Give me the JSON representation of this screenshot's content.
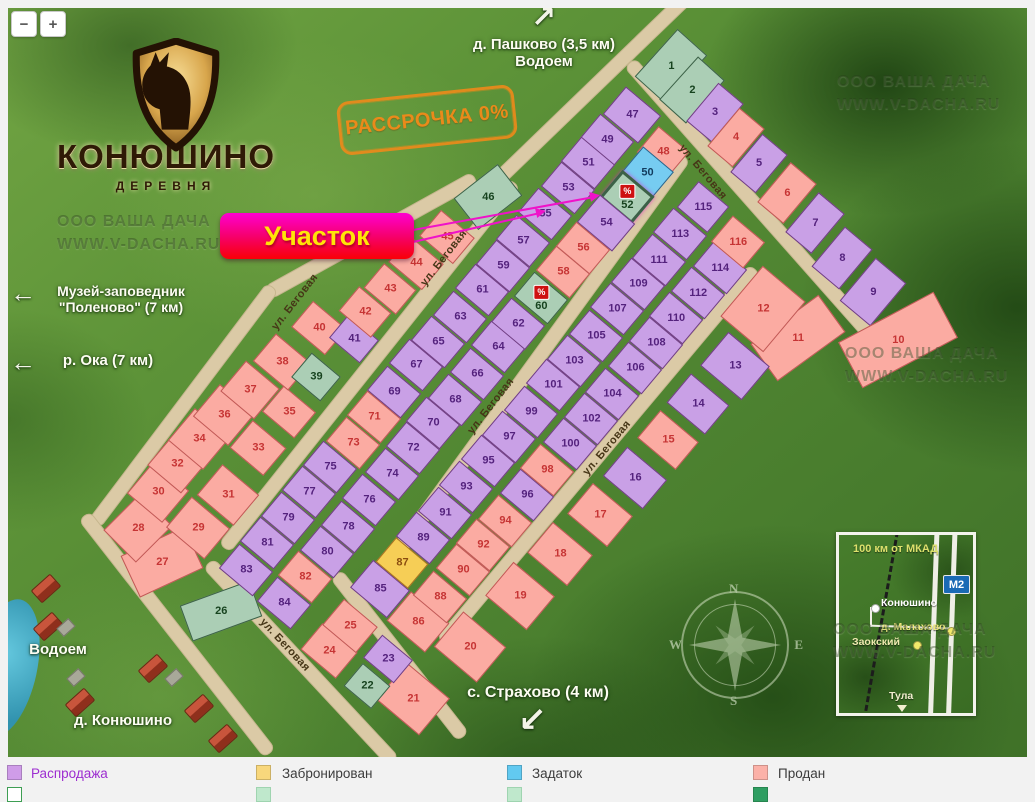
{
  "controls": {
    "zoom_out": "−",
    "zoom_in": "+"
  },
  "logo": {
    "title": "КОНЮШИНО",
    "subtitle": "ДЕРЕВНЯ"
  },
  "promo": {
    "text": "РАССРОЧКА 0%"
  },
  "uchastok": {
    "label": "Участок",
    "pointer_lines": [
      {
        "x1": 413,
        "y1": 241,
        "x2": 540,
        "y2": 212
      },
      {
        "x1": 413,
        "y1": 229,
        "x2": 594,
        "y2": 196
      }
    ]
  },
  "landmarks": [
    {
      "lines": [
        "д. Пашково (3,5 км)",
        "Водоем"
      ],
      "x": 544,
      "y": 36,
      "size": 15,
      "arrow": "↗",
      "ax": 531,
      "ay": 0,
      "asize": 30
    },
    {
      "lines": [
        "Музей-заповедник",
        "\"Поленово\" (7 км)"
      ],
      "x": 121,
      "y": 283,
      "size": 14,
      "arrow": "←",
      "ax": 10,
      "ay": 278,
      "asize": 26
    },
    {
      "lines": [
        "р. Ока (7 км)"
      ],
      "x": 108,
      "y": 352,
      "size": 15,
      "arrow": "←",
      "ax": 10,
      "ay": 347,
      "asize": 26
    },
    {
      "lines": [
        "Водоем"
      ],
      "x": 58,
      "y": 641,
      "size": 15
    },
    {
      "lines": [
        "д. Конюшино"
      ],
      "x": 123,
      "y": 712,
      "size": 15
    },
    {
      "lines": [
        "с. Страхово (4 км)"
      ],
      "x": 538,
      "y": 684,
      "size": 16,
      "arrow": "↙",
      "ax": 518,
      "ay": 700,
      "asize": 34
    }
  ],
  "streets": {
    "label": "ул. Беговая",
    "labels": [
      {
        "x": 296,
        "y": 302,
        "rot": -52
      },
      {
        "x": 445,
        "y": 258,
        "rot": -52
      },
      {
        "x": 492,
        "y": 406,
        "rot": -52
      },
      {
        "x": 608,
        "y": 448,
        "rot": -50
      },
      {
        "x": 704,
        "y": 172,
        "rot": 50
      },
      {
        "x": 286,
        "y": 645,
        "rot": 47
      }
    ]
  },
  "roads": [
    [
      594,
      85,
      265,
      -44
    ],
    [
      370,
      235,
      235,
      -29
    ],
    [
      182,
      405,
      295,
      -53
    ],
    [
      176,
      634,
      300,
      52
    ],
    [
      368,
      365,
      465,
      -51.5
    ],
    [
      536,
      359,
      500,
      -54
    ],
    [
      597,
      455,
      485,
      -50
    ],
    [
      755,
      205,
      380,
      48.5
    ],
    [
      300,
      662,
      270,
      47
    ],
    [
      398,
      655,
      205,
      52
    ]
  ],
  "statuses": {
    "p": {
      "name": "Распродажа",
      "fill": "#c9a0e6",
      "num": "#54227d",
      "border": "rgba(82,28,96,0.75)"
    },
    "r": {
      "name": "Продан",
      "fill": "#fbaba2",
      "num": "#c63434",
      "border": "rgba(168,52,52,0.7)"
    },
    "g": {
      "name": "Свободен",
      "fill": "#abceb5",
      "num": "#17431f",
      "border": "rgba(32,70,44,0.8)"
    },
    "b": {
      "name": "Задаток",
      "fill": "#76ccf1",
      "num": "#123c5e",
      "border": "rgba(26,72,110,0.8)"
    },
    "y": {
      "name": "Забронирован",
      "fill": "#f6ce56",
      "num": "#8a4d10",
      "border": "rgba(150,90,20,0.8)"
    }
  },
  "plots": [
    [
      1,
      671,
      66,
      "g",
      64,
      40,
      -48
    ],
    [
      2,
      692,
      90,
      "g",
      58,
      36,
      -48
    ],
    [
      3,
      715,
      112,
      "p",
      50,
      33
    ],
    [
      4,
      736,
      137,
      "r",
      50,
      33
    ],
    [
      5,
      759,
      163,
      "p",
      50,
      33
    ],
    [
      6,
      787,
      193,
      "r",
      52,
      34
    ],
    [
      7,
      815,
      223,
      "p",
      52,
      34
    ],
    [
      8,
      842,
      258,
      "p",
      52,
      36
    ],
    [
      9,
      873,
      292,
      "p",
      56,
      40
    ],
    [
      10,
      898,
      340,
      "r",
      108,
      52,
      -28
    ],
    [
      11,
      798,
      338,
      "r",
      84,
      46,
      -36
    ],
    [
      12,
      763,
      309,
      "r",
      66,
      56
    ],
    [
      13,
      735,
      366,
      "p",
      44,
      54
    ],
    [
      14,
      698,
      404,
      "p",
      38,
      50
    ],
    [
      15,
      668,
      440,
      "r",
      36,
      50
    ],
    [
      16,
      635,
      478,
      "p",
      38,
      52
    ],
    [
      17,
      600,
      515,
      "r",
      40,
      52
    ],
    [
      18,
      560,
      554,
      "r",
      40,
      52
    ],
    [
      19,
      520,
      596,
      "r",
      44,
      54
    ],
    [
      20,
      470,
      647,
      "r",
      46,
      56
    ],
    [
      21,
      413,
      699,
      "r",
      48,
      56
    ],
    [
      22,
      367,
      686,
      "g",
      30,
      36
    ],
    [
      23,
      388,
      659,
      "p",
      30,
      40
    ],
    [
      24,
      329,
      651,
      "r",
      34,
      46
    ],
    [
      25,
      350,
      626,
      "r",
      34,
      44
    ],
    [
      26,
      221,
      611,
      "g",
      74,
      38,
      -20
    ],
    [
      27,
      162,
      562,
      "r",
      70,
      46,
      -25
    ],
    [
      28,
      138,
      528,
      "r",
      52,
      46,
      -45
    ],
    [
      29,
      198,
      528,
      "r",
      40,
      50
    ],
    [
      30,
      158,
      492,
      "r",
      42,
      46
    ],
    [
      31,
      228,
      495,
      "r",
      40,
      48
    ],
    [
      32,
      177,
      464,
      "r",
      40,
      44
    ],
    [
      33,
      258,
      448,
      "r",
      36,
      44
    ],
    [
      34,
      199,
      439,
      "r",
      42,
      46
    ],
    [
      35,
      289,
      412,
      "r",
      34,
      42
    ],
    [
      36,
      224,
      415,
      "r",
      42,
      46
    ],
    [
      37,
      250,
      390,
      "r",
      40,
      44
    ],
    [
      38,
      282,
      362,
      "r",
      36,
      46
    ],
    [
      39,
      316,
      377,
      "g",
      32,
      38
    ],
    [
      40,
      319,
      328,
      "r",
      34,
      44
    ],
    [
      41,
      354,
      339,
      "p",
      30,
      40
    ],
    [
      42,
      365,
      312,
      "r",
      32,
      42
    ],
    [
      43,
      390,
      289,
      "r",
      32,
      42
    ],
    [
      44,
      416,
      263,
      "r",
      34,
      44
    ],
    [
      45,
      447,
      237,
      "r",
      34,
      44
    ],
    [
      46,
      488,
      197,
      "g",
      56,
      40,
      -38
    ],
    [
      47,
      632,
      115,
      "p",
      36,
      46
    ],
    [
      48,
      663,
      152,
      "r",
      34,
      40
    ],
    [
      49,
      607,
      140,
      "p"
    ],
    [
      50,
      647,
      173,
      "b",
      36,
      40
    ],
    [
      51,
      588,
      163,
      "p"
    ],
    [
      52,
      627,
      197,
      "g",
      36,
      42
    ],
    [
      53,
      568,
      188,
      "p"
    ],
    [
      54,
      606,
      223,
      "p",
      36,
      46
    ],
    [
      55,
      545,
      214,
      "p"
    ],
    [
      56,
      583,
      248,
      "r"
    ],
    [
      57,
      523,
      241,
      "p"
    ],
    [
      58,
      563,
      272,
      "r"
    ],
    [
      59,
      503,
      266,
      "p"
    ],
    [
      60,
      541,
      298,
      "g"
    ],
    [
      61,
      482,
      290,
      "p"
    ],
    [
      62,
      518,
      324,
      "p"
    ],
    [
      63,
      460,
      317,
      "p"
    ],
    [
      64,
      498,
      347,
      "p"
    ],
    [
      65,
      438,
      342,
      "p"
    ],
    [
      66,
      477,
      374,
      "p"
    ],
    [
      67,
      416,
      365,
      "p"
    ],
    [
      68,
      455,
      400,
      "p"
    ],
    [
      69,
      394,
      392,
      "p"
    ],
    [
      70,
      433,
      423,
      "p"
    ],
    [
      71,
      374,
      417,
      "r"
    ],
    [
      72,
      413,
      448,
      "p"
    ],
    [
      73,
      353,
      443,
      "r"
    ],
    [
      74,
      392,
      474,
      "p"
    ],
    [
      75,
      330,
      467,
      "p"
    ],
    [
      76,
      369,
      500,
      "p"
    ],
    [
      77,
      309,
      492,
      "p"
    ],
    [
      78,
      348,
      527,
      "p"
    ],
    [
      79,
      288,
      518,
      "p"
    ],
    [
      80,
      327,
      552,
      "p"
    ],
    [
      81,
      267,
      543,
      "p"
    ],
    [
      82,
      305,
      577,
      "r"
    ],
    [
      83,
      246,
      570,
      "p"
    ],
    [
      84,
      284,
      603,
      "p"
    ],
    [
      85,
      380,
      589,
      "p",
      36,
      48
    ],
    [
      86,
      418,
      622,
      "r",
      38,
      50
    ],
    [
      87,
      402,
      563,
      "y",
      32,
      42
    ],
    [
      88,
      440,
      597,
      "r"
    ],
    [
      89,
      423,
      538,
      "p"
    ],
    [
      90,
      463,
      570,
      "r"
    ],
    [
      91,
      445,
      513,
      "p"
    ],
    [
      92,
      483,
      545,
      "r"
    ],
    [
      93,
      466,
      487,
      "p"
    ],
    [
      94,
      505,
      521,
      "r"
    ],
    [
      95,
      488,
      461,
      "p"
    ],
    [
      96,
      527,
      495,
      "p"
    ],
    [
      97,
      509,
      437,
      "p"
    ],
    [
      98,
      547,
      470,
      "r"
    ],
    [
      99,
      531,
      412,
      "p"
    ],
    [
      100,
      570,
      444,
      "p"
    ],
    [
      101,
      553,
      385,
      "p"
    ],
    [
      102,
      591,
      419,
      "p"
    ],
    [
      103,
      574,
      361,
      "p"
    ],
    [
      104,
      612,
      394,
      "p"
    ],
    [
      105,
      596,
      336,
      "p"
    ],
    [
      106,
      635,
      368,
      "p"
    ],
    [
      107,
      617,
      309,
      "p"
    ],
    [
      108,
      656,
      343,
      "p"
    ],
    [
      109,
      638,
      284,
      "p"
    ],
    [
      110,
      676,
      318,
      "p"
    ],
    [
      111,
      659,
      260,
      "p"
    ],
    [
      112,
      698,
      293,
      "p"
    ],
    [
      113,
      680,
      234,
      "p"
    ],
    [
      114,
      720,
      268,
      "p"
    ],
    [
      115,
      703,
      207,
      "p",
      34,
      40
    ],
    [
      116,
      738,
      242,
      "r",
      34,
      42
    ]
  ],
  "special_plots": {
    "highlight": 52,
    "percent_badges": [
      52,
      60
    ],
    "badge_text": "%"
  },
  "watermark": {
    "lines": [
      "ООО ВАША ДАЧА",
      "WWW.V-DACHA.RU"
    ],
    "positions": [
      [
        57,
        210
      ],
      [
        837,
        70
      ],
      [
        845,
        342
      ],
      [
        833,
        618
      ]
    ]
  },
  "scenery": {
    "houses": [
      [
        33,
        580
      ],
      [
        35,
        618
      ],
      [
        67,
        694
      ],
      [
        140,
        660
      ],
      [
        186,
        700
      ],
      [
        210,
        730
      ]
    ],
    "sheds": [
      [
        58,
        622
      ],
      [
        68,
        672
      ],
      [
        166,
        672
      ]
    ]
  },
  "compass": {
    "n": "N",
    "s": "S",
    "w": "W",
    "e": "E"
  },
  "inset": {
    "title": "100 км от МКАД",
    "badge": "М2",
    "roads_x": [
      92,
      110
    ],
    "points": [
      {
        "label": "Конюшино",
        "dot": "#ffffff",
        "dx": 32,
        "dy": 69,
        "lx": 42,
        "ly": 62,
        "color": "#ffffff"
      },
      {
        "label": "д. Малахово",
        "dot": "#f3e96a",
        "dx": 108,
        "dy": 92,
        "lx": 42,
        "ly": 86,
        "color": "#efe87c"
      },
      {
        "label": "Заокский",
        "dot": "#f3e96a",
        "dx": 74,
        "dy": 106,
        "lx": 13,
        "ly": 101,
        "color": "#efeab0"
      },
      {
        "label": "Тула",
        "dot": "triangle",
        "dx": 58,
        "dy": 170,
        "lx": 50,
        "ly": 155,
        "color": "#f2efcf"
      }
    ]
  },
  "legend": {
    "y": 765,
    "y2": 787,
    "items": [
      {
        "label": "Распродажа",
        "swatch": "#cf9ce8",
        "label_color": "#9d2ed0",
        "x": 7,
        "tx": 31
      },
      {
        "label": "Забронирован",
        "swatch": "#f8d77c",
        "label_color": "#3c3c3c",
        "x": 256,
        "tx": 282
      },
      {
        "label": "Задаток",
        "swatch": "#62c9f0",
        "label_color": "#3c3c3c",
        "x": 507,
        "tx": 532
      },
      {
        "label": "Продан",
        "swatch": "#fbb1a8",
        "label_color": "#3c3c3c",
        "x": 753,
        "tx": 778
      }
    ],
    "partial_row": [
      {
        "x": 7,
        "swatch": "#ffffff",
        "border": "#3e9e53"
      },
      {
        "x": 256,
        "swatch": "#bfe8cc",
        "border": "#9fd4b0"
      },
      {
        "x": 507,
        "swatch": "#bfe8cc",
        "border": "#9fd4b0"
      },
      {
        "x": 753,
        "swatch": "#2f9e62",
        "border": "#27854f"
      }
    ]
  }
}
